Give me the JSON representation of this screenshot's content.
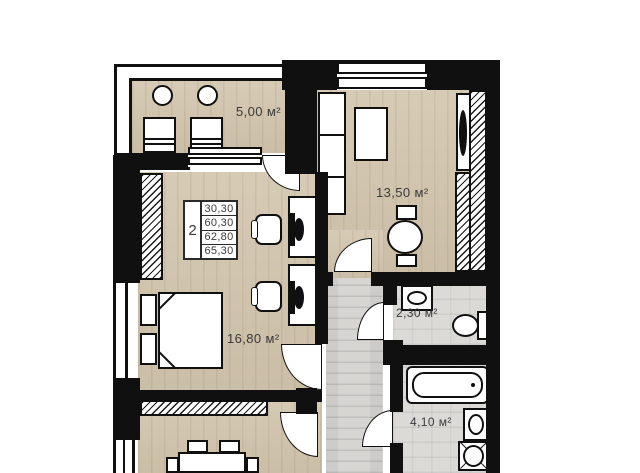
{
  "floor_plan": {
    "legend": {
      "rooms_count": "2",
      "area_rows": [
        "30,30",
        "60,30",
        "62,80",
        "65,30"
      ]
    },
    "rooms": {
      "balcony": {
        "area": "5,00 м²"
      },
      "bedroom": {
        "area": "13,50 м²"
      },
      "living_room": {
        "area": "16,80 м²"
      },
      "toilet": {
        "area": "2,30 м²"
      },
      "bathroom": {
        "area": "4,10 м²"
      }
    },
    "colors": {
      "wall": "#101010",
      "wood_floor": "#d3c5ad",
      "gray_floor": "#d6d5d2",
      "background": "#ffffff"
    }
  }
}
